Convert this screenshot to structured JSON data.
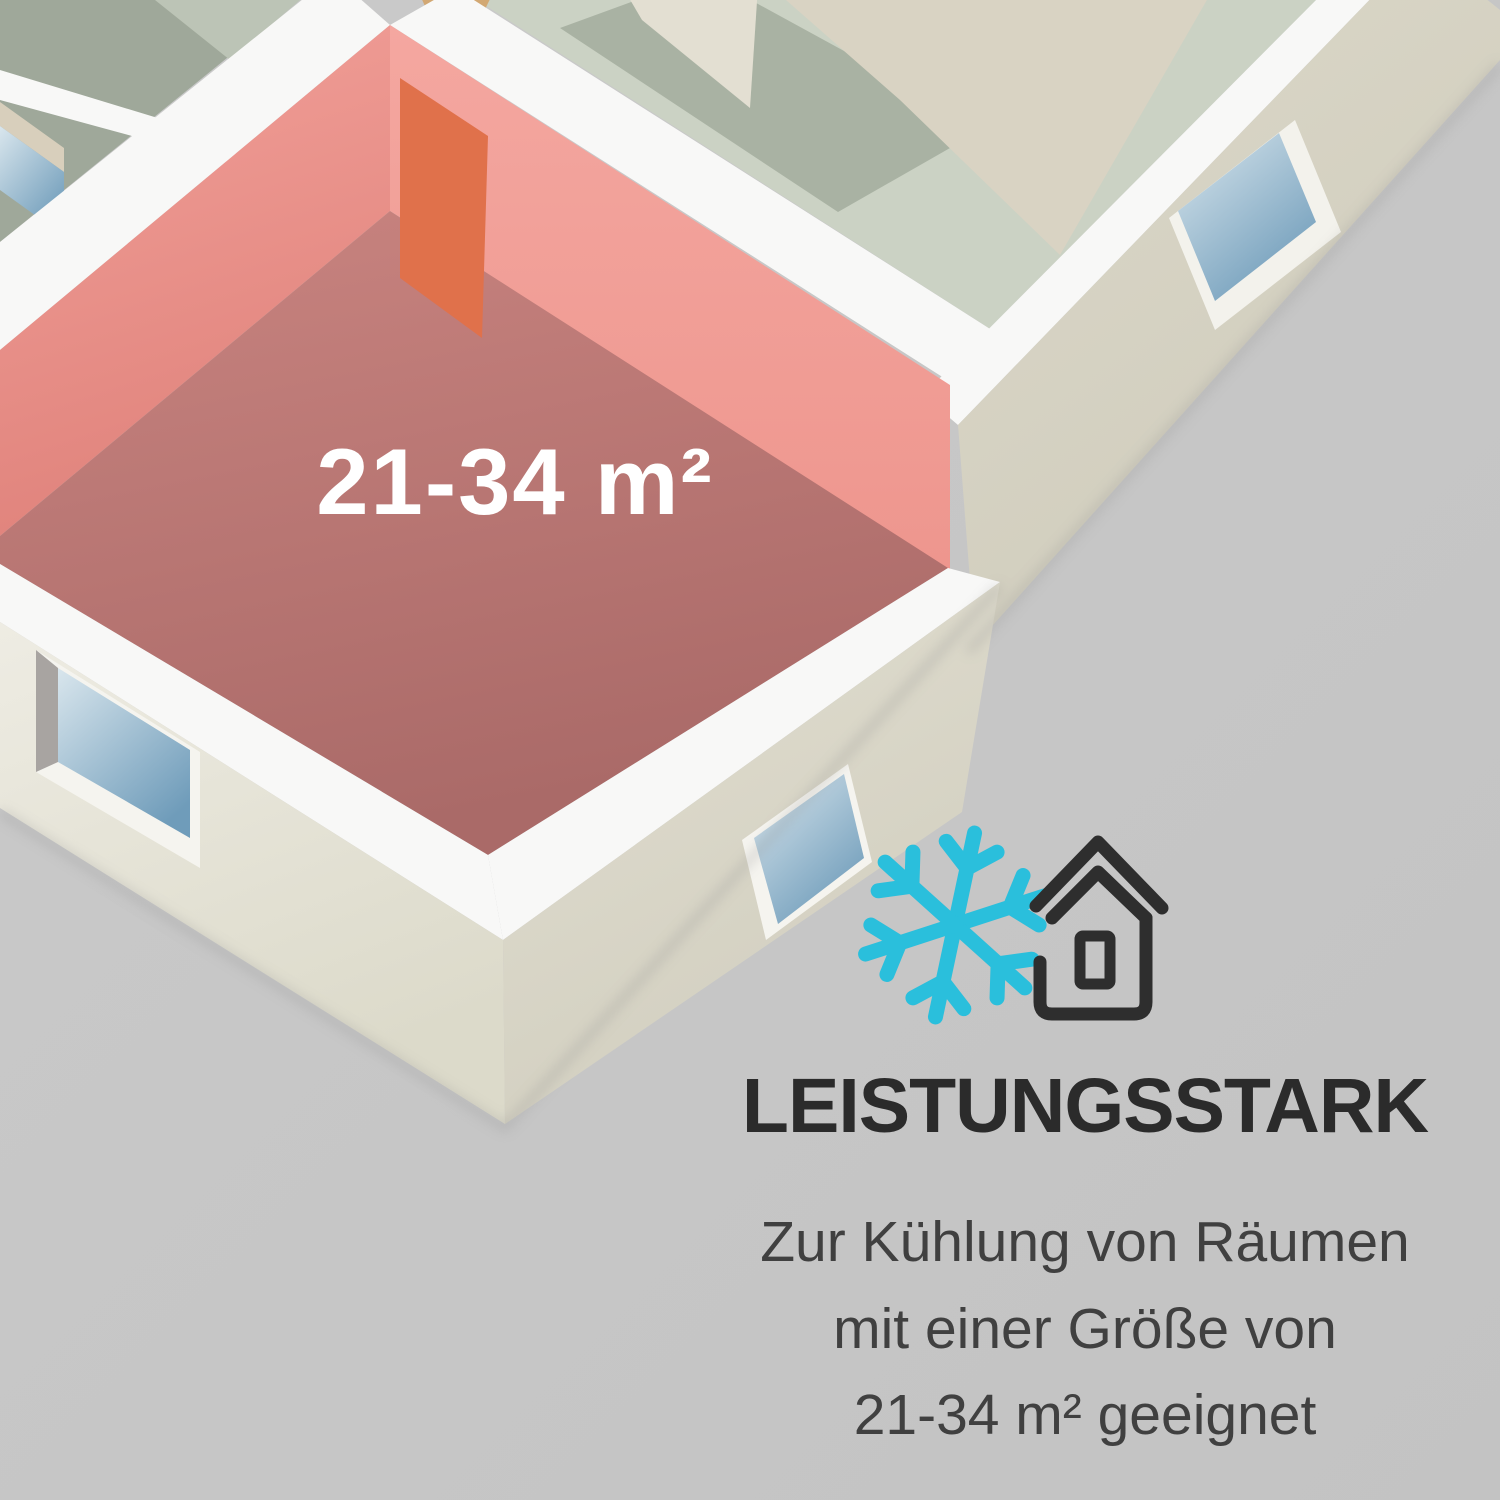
{
  "floorplan": {
    "room_area_label": "21-34 m²"
  },
  "info": {
    "heading": "LEISTUNGSSTARK",
    "lines": [
      "Zur Kühlung von Räumen",
      "mit einer Größe von",
      "21-34 m² geeignet"
    ]
  },
  "icons": {
    "snowflake": "snowflake-icon",
    "house": "house-icon"
  },
  "colors": {
    "background": "#c7c7c7",
    "accent_cyan": "#2abfdc",
    "icon_black": "#2e2e2e",
    "heading_text": "#2b2b2b",
    "body_text": "#404040",
    "label_text": "#ffffff",
    "room_wall_salmon": "#ee968f",
    "room_floor_rose": "#b5706e",
    "door_orange": "#e0714b",
    "wall_top_white": "#f8f8f7",
    "exterior_cream": "#dfddcf",
    "sage_floor": "#cbd2c4",
    "sage_dark": "#a9b2a3",
    "gray_green_floor": "#9fa89a",
    "sand_floor": "#d9d3c3",
    "tan_accent": "#d2a873",
    "window_blue": "#9fc0d6"
  }
}
